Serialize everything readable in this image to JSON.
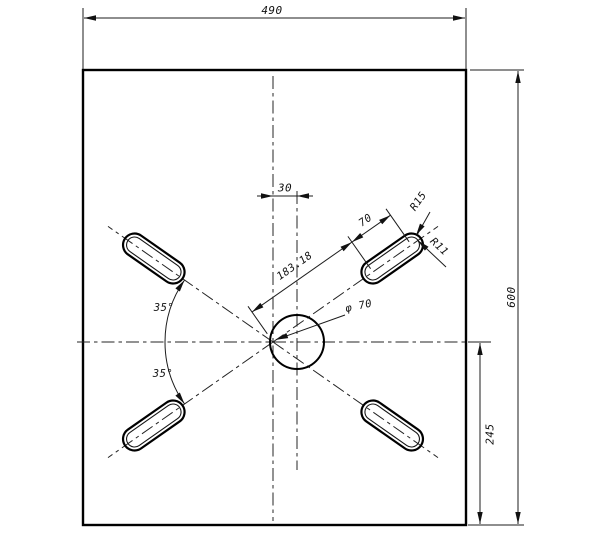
{
  "drawing": {
    "labels": {
      "plate_width": "490",
      "plate_height": "600",
      "hole_bottom_offset": "245",
      "hole_center_offset": "30",
      "slot_distance": "183.18",
      "slot_length": "70",
      "slot_outer_radius": "R15",
      "slot_inner_radius": "R11",
      "hole_diameter": "φ 70",
      "angle_upper": "35°",
      "angle_lower": "35°"
    },
    "colors": {
      "line": "#111111",
      "background": "#ffffff"
    }
  }
}
